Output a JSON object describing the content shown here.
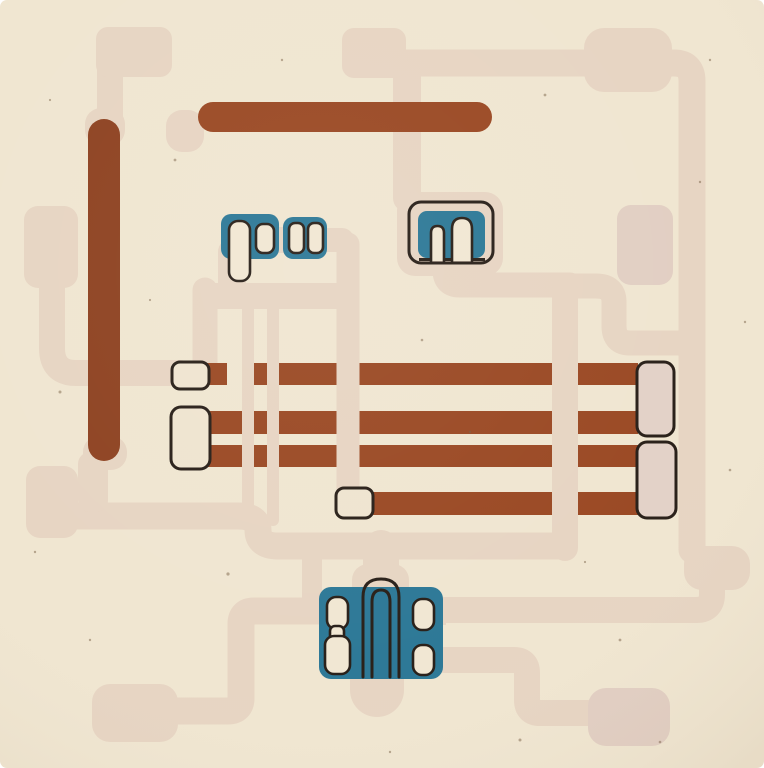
{
  "artwork": {
    "medium": "painting",
    "subject": "abstract circuit-board composition",
    "colors": {
      "background": "#f0e6d1",
      "trace": "#e7d5c3",
      "trace_pink": "#e2cfc3",
      "pad_cream": "#efe4d0",
      "pad_pink": "#e3d2c8",
      "brown": "#9b4a25",
      "brown_dark": "#8f4423",
      "teal": "#2e7997",
      "outline": "#2a211a",
      "cream": "#f1e7d3",
      "speckle": "#7a6148"
    }
  }
}
